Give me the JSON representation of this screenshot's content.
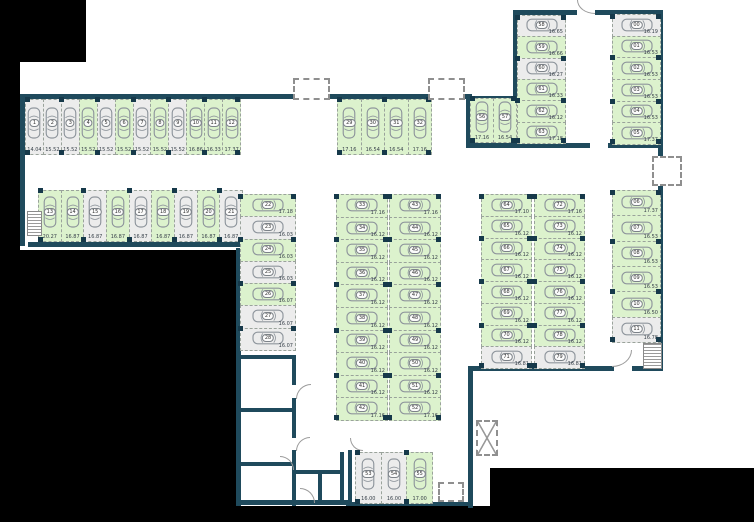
{
  "colors": {
    "available": "#dcf2cd",
    "occupied": "#ececec",
    "wall": "#1f4a5c",
    "outside": "#000000",
    "car_outline": "#8e959c"
  },
  "icons": {
    "stall_glyph": "car-top-view-icon"
  },
  "areas": [
    {
      "id": "A",
      "stalls": [
        {
          "n": "1",
          "dim": "14.04",
          "state": "occupied"
        },
        {
          "n": "2",
          "dim": "15.52",
          "state": "occupied"
        },
        {
          "n": "3",
          "dim": "15.52",
          "state": "occupied"
        },
        {
          "n": "4",
          "dim": "15.52",
          "state": "available"
        },
        {
          "n": "5",
          "dim": "15.52",
          "state": "occupied"
        },
        {
          "n": "6",
          "dim": "15.52",
          "state": "available"
        },
        {
          "n": "7",
          "dim": "15.52",
          "state": "occupied"
        },
        {
          "n": "8",
          "dim": "15.52",
          "state": "available"
        },
        {
          "n": "9",
          "dim": "15.52",
          "state": "occupied"
        },
        {
          "n": "10",
          "dim": "16.86",
          "state": "available"
        },
        {
          "n": "11",
          "dim": "16.33",
          "state": "available"
        },
        {
          "n": "12",
          "dim": "17.37",
          "state": "available"
        }
      ]
    },
    {
      "id": "B",
      "stalls": [
        {
          "n": "29",
          "dim": "17.16",
          "state": "available"
        },
        {
          "n": "30",
          "dim": "16.54",
          "state": "available"
        },
        {
          "n": "31",
          "dim": "16.54",
          "state": "available"
        },
        {
          "n": "32",
          "dim": "17.16",
          "state": "available"
        }
      ]
    },
    {
      "id": "C",
      "stalls": [
        {
          "n": "13",
          "dim": "20.27",
          "state": "available"
        },
        {
          "n": "14",
          "dim": "16.87",
          "state": "available"
        },
        {
          "n": "15",
          "dim": "16.87",
          "state": "occupied"
        },
        {
          "n": "16",
          "dim": "16.87",
          "state": "available"
        },
        {
          "n": "17",
          "dim": "16.87",
          "state": "occupied"
        },
        {
          "n": "18",
          "dim": "16.87",
          "state": "available"
        },
        {
          "n": "19",
          "dim": "16.87",
          "state": "occupied"
        },
        {
          "n": "20",
          "dim": "16.87",
          "state": "available"
        },
        {
          "n": "21",
          "dim": "16.87",
          "state": "occupied"
        }
      ]
    },
    {
      "id": "D",
      "stalls": [
        {
          "n": "22",
          "dim": "17.18",
          "state": "available"
        },
        {
          "n": "23",
          "dim": "16.03",
          "state": "occupied"
        },
        {
          "n": "24",
          "dim": "16.03",
          "state": "available"
        },
        {
          "n": "25",
          "dim": "16.03",
          "state": "occupied"
        },
        {
          "n": "26",
          "dim": "16.07",
          "state": "available"
        },
        {
          "n": "27",
          "dim": "16.07",
          "state": "occupied"
        },
        {
          "n": "28",
          "dim": "16.07",
          "state": "occupied"
        }
      ]
    },
    {
      "id": "E1",
      "stalls": [
        {
          "n": "33",
          "dim": "17.16",
          "state": "available"
        },
        {
          "n": "34",
          "dim": "16.12",
          "state": "available"
        },
        {
          "n": "35",
          "dim": "16.12",
          "state": "available"
        },
        {
          "n": "36",
          "dim": "16.12",
          "state": "available"
        },
        {
          "n": "37",
          "dim": "16.12",
          "state": "available"
        },
        {
          "n": "38",
          "dim": "16.12",
          "state": "available"
        },
        {
          "n": "39",
          "dim": "16.12",
          "state": "available"
        },
        {
          "n": "40",
          "dim": "16.12",
          "state": "available"
        },
        {
          "n": "41",
          "dim": "16.12",
          "state": "available"
        },
        {
          "n": "42",
          "dim": "17.16",
          "state": "available"
        }
      ]
    },
    {
      "id": "E2",
      "stalls": [
        {
          "n": "43",
          "dim": "17.16",
          "state": "available"
        },
        {
          "n": "44",
          "dim": "16.12",
          "state": "available"
        },
        {
          "n": "45",
          "dim": "16.12",
          "state": "available"
        },
        {
          "n": "46",
          "dim": "16.12",
          "state": "available"
        },
        {
          "n": "47",
          "dim": "16.12",
          "state": "available"
        },
        {
          "n": "48",
          "dim": "16.12",
          "state": "available"
        },
        {
          "n": "49",
          "dim": "16.12",
          "state": "available"
        },
        {
          "n": "50",
          "dim": "16.12",
          "state": "available"
        },
        {
          "n": "51",
          "dim": "16.12",
          "state": "available"
        },
        {
          "n": "52",
          "dim": "17.16",
          "state": "available"
        }
      ]
    },
    {
      "id": "F",
      "stalls": [
        {
          "n": "53",
          "dim": "16.00",
          "state": "occupied"
        },
        {
          "n": "54",
          "dim": "16.00",
          "state": "occupied"
        },
        {
          "n": "55",
          "dim": "17.00",
          "state": "available"
        }
      ]
    },
    {
      "id": "G",
      "stalls": [
        {
          "n": "56",
          "dim": "17.16",
          "state": "available"
        },
        {
          "n": "57",
          "dim": "16.54",
          "state": "available"
        }
      ]
    },
    {
      "id": "H",
      "stalls": [
        {
          "n": "58",
          "dim": "16.65",
          "state": "occupied"
        },
        {
          "n": "59",
          "dim": "16.66",
          "state": "available"
        },
        {
          "n": "60",
          "dim": "16.27",
          "state": "occupied"
        },
        {
          "n": "61",
          "dim": "16.33",
          "state": "available"
        },
        {
          "n": "62",
          "dim": "16.12",
          "state": "available"
        },
        {
          "n": "63",
          "dim": "17.18",
          "state": "available"
        }
      ]
    },
    {
      "id": "I",
      "stalls": [
        {
          "n": "00",
          "dim": "16.19",
          "state": "occupied"
        },
        {
          "n": "01",
          "dim": "16.53",
          "state": "available"
        },
        {
          "n": "02",
          "dim": "16.53",
          "state": "available"
        },
        {
          "n": "03",
          "dim": "16.53",
          "state": "available"
        },
        {
          "n": "04",
          "dim": "16.53",
          "state": "available"
        },
        {
          "n": "05",
          "dim": "17.37",
          "state": "available"
        }
      ]
    },
    {
      "id": "J",
      "stalls": [
        {
          "n": "06",
          "dim": "17.37",
          "state": "available"
        },
        {
          "n": "07",
          "dim": "16.53",
          "state": "available"
        },
        {
          "n": "08",
          "dim": "16.53",
          "state": "available"
        },
        {
          "n": "09",
          "dim": "16.53",
          "state": "available"
        },
        {
          "n": "10",
          "dim": "16.50",
          "state": "available"
        },
        {
          "n": "11",
          "dim": "16.78",
          "state": "occupied"
        }
      ]
    },
    {
      "id": "K",
      "stalls": [
        {
          "n": "64",
          "dim": "17.10",
          "state": "available"
        },
        {
          "n": "65",
          "dim": "16.12",
          "state": "available"
        },
        {
          "n": "66",
          "dim": "16.12",
          "state": "available"
        },
        {
          "n": "67",
          "dim": "16.12",
          "state": "available"
        },
        {
          "n": "68",
          "dim": "16.12",
          "state": "available"
        },
        {
          "n": "69",
          "dim": "16.12",
          "state": "available"
        },
        {
          "n": "70",
          "dim": "16.12",
          "state": "available"
        },
        {
          "n": "71",
          "dim": "16.81",
          "state": "occupied"
        }
      ]
    },
    {
      "id": "L",
      "stalls": [
        {
          "n": "72",
          "dim": "17.16",
          "state": "available"
        },
        {
          "n": "73",
          "dim": "16.12",
          "state": "available"
        },
        {
          "n": "74",
          "dim": "16.12",
          "state": "available"
        },
        {
          "n": "75",
          "dim": "16.12",
          "state": "available"
        },
        {
          "n": "76",
          "dim": "16.12",
          "state": "available"
        },
        {
          "n": "77",
          "dim": "16.12",
          "state": "available"
        },
        {
          "n": "78",
          "dim": "16.12",
          "state": "available"
        },
        {
          "n": "79",
          "dim": "16.81",
          "state": "occupied"
        }
      ]
    }
  ]
}
